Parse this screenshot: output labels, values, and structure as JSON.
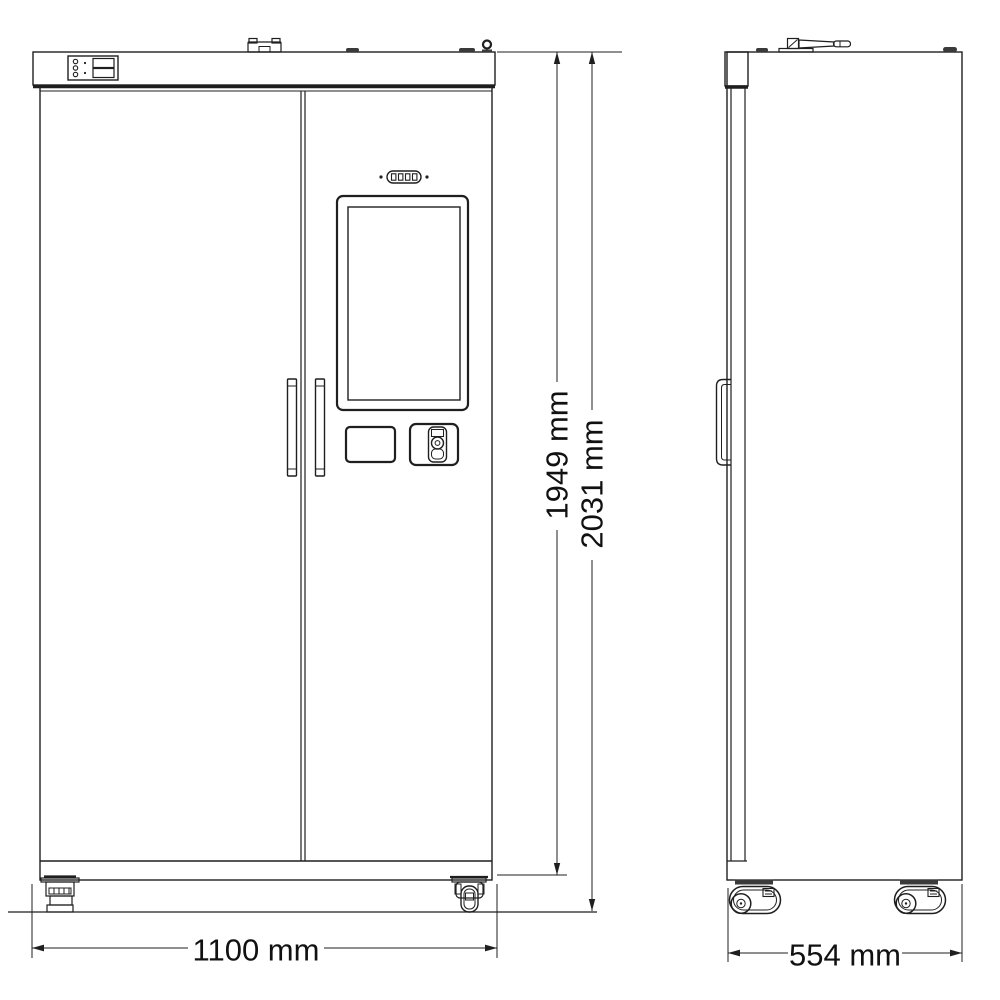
{
  "canvas": {
    "background": "#ffffff",
    "line_color": "#1f1f1f",
    "dark_fill": "#3a3a3a",
    "text_color": "#111111"
  },
  "figure": {
    "type": "technical-drawing",
    "subject": "Smart storage cabinet - front and side elevation views with overall dimensions",
    "views": [
      {
        "id": "front-view",
        "position": "left"
      },
      {
        "id": "side-view",
        "position": "right"
      }
    ]
  },
  "dimensions": {
    "front_width": {
      "label": "1100 mm",
      "orientation": "horizontal",
      "view": "front"
    },
    "cabinet_height": {
      "label": "1949 mm",
      "orientation": "vertical",
      "view": "front"
    },
    "overall_height": {
      "label": "2031 mm",
      "orientation": "vertical",
      "view": "front"
    },
    "depth": {
      "label": "554 mm",
      "orientation": "horizontal",
      "view": "side"
    }
  },
  "components": {
    "front_view": [
      "top-band",
      "status-panel-with-leds",
      "top-latch-bracket",
      "lift-ring",
      "left-door",
      "right-door",
      "door-handles",
      "led-indicator-strip",
      "touchscreen-display",
      "card-reader-tray",
      "cam-lock",
      "kick-plate",
      "leveling-foot",
      "swivel-caster"
    ],
    "side_view": [
      "door-edge-profile",
      "wifi-antenna",
      "hinge-caps",
      "side-door-handle",
      "swivel-casters"
    ]
  }
}
